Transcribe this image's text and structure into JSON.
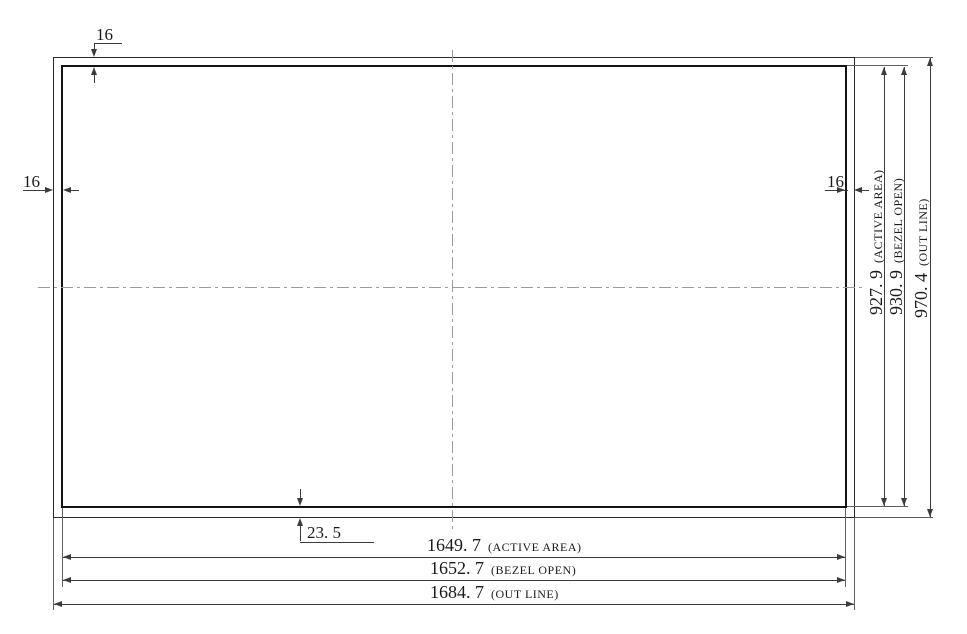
{
  "dimensions": {
    "width": [
      {
        "value": "1649. 7",
        "unit_label": "(ACTIVE AREA)"
      },
      {
        "value": "1652. 7",
        "unit_label": "(BEZEL OPEN)"
      },
      {
        "value": "1684. 7",
        "unit_label": "(OUT LINE)"
      }
    ],
    "height": [
      {
        "value": "927. 9",
        "unit_label": "(ACTIVE AREA)"
      },
      {
        "value": "930. 9",
        "unit_label": "(BEZEL OPEN)"
      },
      {
        "value": "970. 4",
        "unit_label": "(OUT LINE)"
      }
    ],
    "bezel": {
      "top": "16",
      "left": "16",
      "right": "16",
      "bottom": "23. 5"
    }
  },
  "colors": {
    "line_dark": "#2a2a2a",
    "line_heavy": "#141414",
    "line_dim": "#3c3c3c",
    "line_ext": "#606060",
    "centerline": "#9b9b9b",
    "text": "#1a1a1a",
    "background": "#ffffff"
  }
}
